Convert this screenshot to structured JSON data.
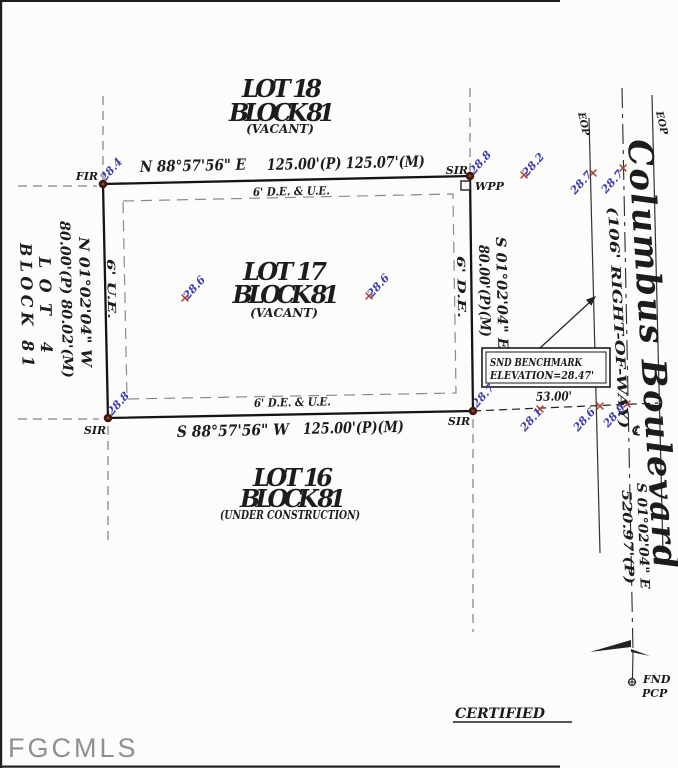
{
  "watermark": "FGCMLS",
  "lots": {
    "lot18": {
      "line1": "LOT 18",
      "line2": "BLOCK 81",
      "line3": "(VACANT)"
    },
    "lot17": {
      "line1": "LOT 17",
      "line2": "BLOCK 81",
      "line3": "(VACANT)"
    },
    "lot16": {
      "line1": "LOT 16",
      "line2": "BLOCK 81",
      "line3": "(UNDER CONSTRUCTION)"
    },
    "lot4": {
      "line1": "LOT 4",
      "line2": "BLOCK 81"
    }
  },
  "boundaries": {
    "north": {
      "bearing": "N 88°57'56\" E",
      "distance": "125.00'(P) 125.07'(M)"
    },
    "south": {
      "bearing": "S 88°57'56\" W",
      "distance": "125.00'(P)(M)"
    },
    "west": {
      "bearing": "N 01°02'04\" W",
      "distance": "80.00'(P) 80.02'(M)"
    },
    "east": {
      "bearing": "S 01°02'04\" E",
      "distance": "80.00'(P)(M)"
    }
  },
  "easements": {
    "top": "6' D.E. & U.E.",
    "bottom": "6' D.E. & U.E.",
    "left": "6' U.E.",
    "right": "6' D.E."
  },
  "road": {
    "name": "Columbus Boulevard",
    "right_of_way": "(106' RIGHT-OF-WAY)",
    "eop_left": "EOP",
    "eop_right": "EOP",
    "centerline_bearing": "S 01°02'04\" E",
    "centerline_distance": "520.97'(P)",
    "centerline_symbol": "℄"
  },
  "monuments": {
    "nw": "FIR",
    "ne": "SIR",
    "sw": "SIR",
    "se": "SIR",
    "wpp": "WPP",
    "fnd_line1": "FND",
    "fnd_line2": "PCP"
  },
  "benchmark": {
    "line1": "SND BENCHMARK",
    "line2": "ELEVATION=28.47'"
  },
  "dimensions": {
    "offset": "53.00'"
  },
  "spots": [
    "28.4",
    "28.8",
    "28.2",
    "28.7",
    "28.7",
    "28.6",
    "28.6",
    "28.8",
    "28.7",
    "28.1",
    "28.6",
    "28.9"
  ],
  "footer": {
    "certified": "CERTIFIED"
  },
  "colors": {
    "elevation_text": "#3c3cae",
    "cross_marker": "#a63d35",
    "corner_dot": "#44170f",
    "line": "#1c1c1c",
    "easement_dash": "#8a8a8a",
    "watermark": "#8f8f8f"
  }
}
